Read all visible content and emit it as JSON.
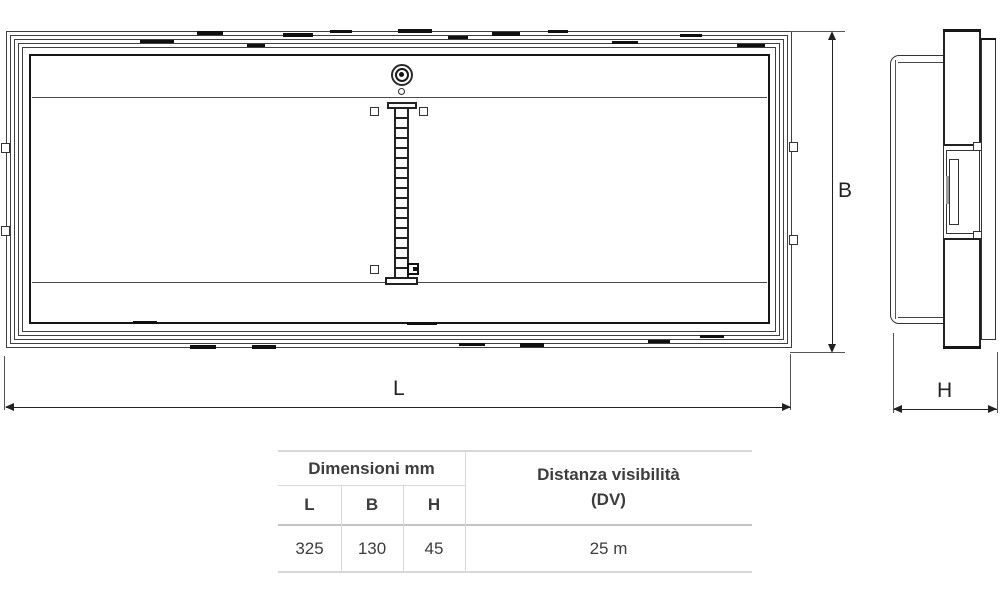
{
  "dimension_labels": {
    "L": "L",
    "B": "B",
    "H": "H"
  },
  "table": {
    "dimensions_header": "Dimensioni mm",
    "visibility_header_line1": "Distanza visibilità",
    "visibility_header_line2": "(DV)",
    "columns": [
      "L",
      "B",
      "H"
    ],
    "row": {
      "L": "325",
      "B": "130",
      "H": "45",
      "DV": "25 m"
    }
  },
  "colors": {
    "line_art": "#2b2b2b",
    "table_border": "#d8d8d8",
    "table_text": "#3d3d3d",
    "background": "#ffffff"
  }
}
